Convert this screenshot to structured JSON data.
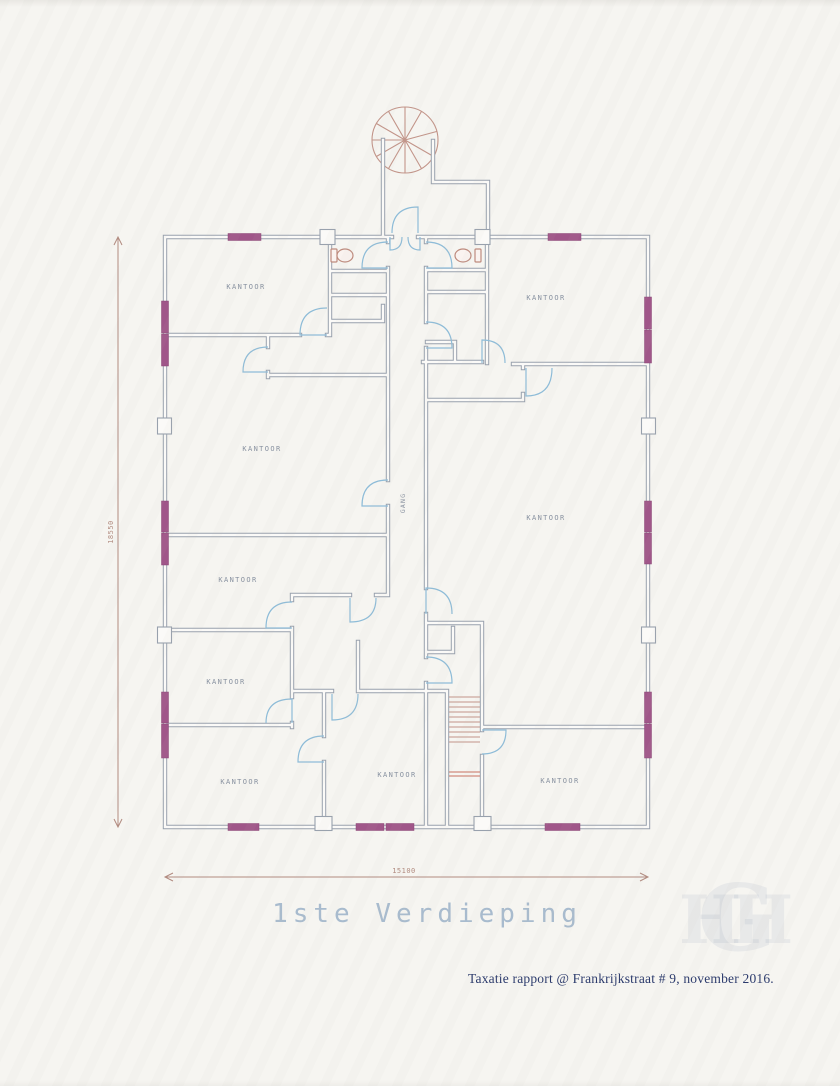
{
  "document": {
    "title": "1ste Verdieping",
    "caption": "Taxatie rapport @ Frankrijkstraat # 9, november 2016.",
    "watermark": {
      "left": "H",
      "center": "G",
      "right": "H"
    }
  },
  "plan": {
    "rooms": [
      {
        "label": "KANTOOR",
        "x": 246,
        "y": 289,
        "position": "top-left"
      },
      {
        "label": "KANTOOR",
        "x": 546,
        "y": 300,
        "position": "top-right"
      },
      {
        "label": "KANTOOR",
        "x": 262,
        "y": 451,
        "position": "mid-left"
      },
      {
        "label": "KANTOOR",
        "x": 546,
        "y": 520,
        "position": "mid-right-large"
      },
      {
        "label": "KANTOOR",
        "x": 238,
        "y": 582,
        "position": "left-small"
      },
      {
        "label": "KANTOOR",
        "x": 226,
        "y": 684,
        "position": "left-lower"
      },
      {
        "label": "KANTOOR",
        "x": 240,
        "y": 784,
        "position": "bottom-left"
      },
      {
        "label": "KANTOOR",
        "x": 397,
        "y": 777,
        "position": "bottom-center"
      },
      {
        "label": "KANTOOR",
        "x": 560,
        "y": 783,
        "position": "bottom-right"
      }
    ],
    "hallway": {
      "label": "GANG"
    },
    "dimensions": {
      "width": "15100",
      "height": "18550"
    }
  },
  "colors": {
    "paper": "#f6f5f1",
    "wall": "#98a1ae",
    "door": "#8cbcd9",
    "window": "#a2558a",
    "fixture": "#c08b7d",
    "stair": "#c49488",
    "stairBreak": "#cb6f5e",
    "dimension": "#b28a7e",
    "roomLabel": "#8690a0",
    "titleColor": "#a7bbcf",
    "captionColor": "#2a3a6e",
    "watermark": "#6b7fa8"
  }
}
